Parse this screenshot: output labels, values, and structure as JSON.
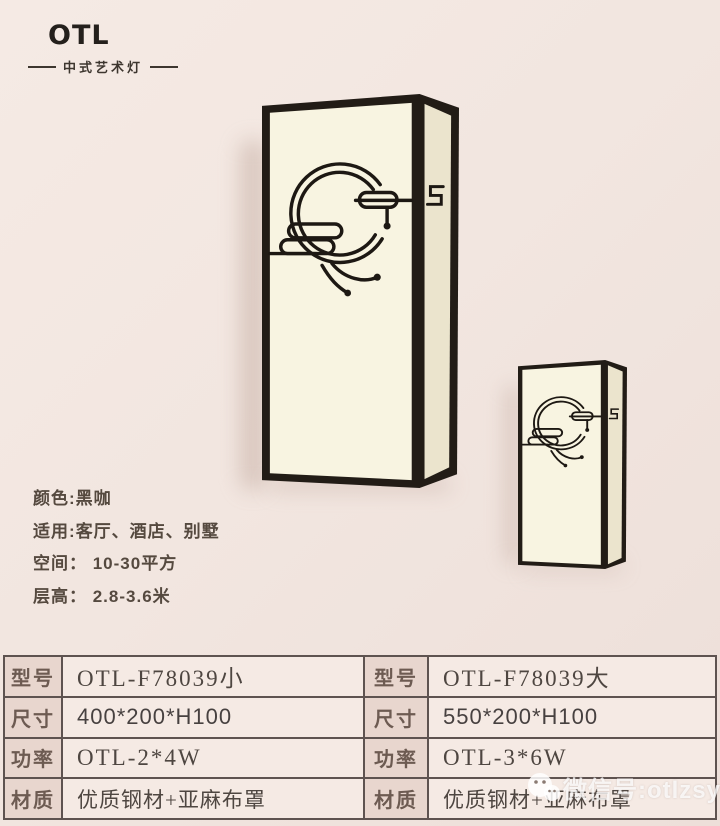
{
  "brand": {
    "logo": "OTL",
    "tagline": "中式艺术灯"
  },
  "product_info": {
    "lines": [
      "颜色:黑咖",
      "适用:客厅、酒店、别墅",
      "空间： 10-30平方",
      "层高： 2.8-3.6米"
    ]
  },
  "spec_table": {
    "rows": [
      {
        "h1": "型号",
        "v1": "OTL-F78039小",
        "h2": "型号",
        "v2": "OTL-F78039大"
      },
      {
        "h1": "尺寸",
        "v1": "400*200*H100",
        "h2": "尺寸",
        "v2": "550*200*H100"
      },
      {
        "h1": "功率",
        "v1": "OTL-2*4W",
        "h2": "功率",
        "v2": "OTL-3*6W"
      },
      {
        "h1": "材质",
        "v1": "优质钢材+亚麻布罩",
        "h2": "材质",
        "v2": "优质钢材+亚麻布罩"
      }
    ]
  },
  "watermark": {
    "icon": "wechat-icon",
    "text": "微信号:otlzsysd"
  },
  "lamps": {
    "large": "wall-lamp-large",
    "small": "wall-lamp-small"
  },
  "colors": {
    "background": "#f2e6e0",
    "lamp_frame": "#221c16",
    "lamp_shade": "#f8f4e1",
    "table_border": "#5e5350",
    "table_header_bg": "#e8d6ce",
    "table_value_bg": "#f5eae4",
    "text": "#55493f"
  }
}
